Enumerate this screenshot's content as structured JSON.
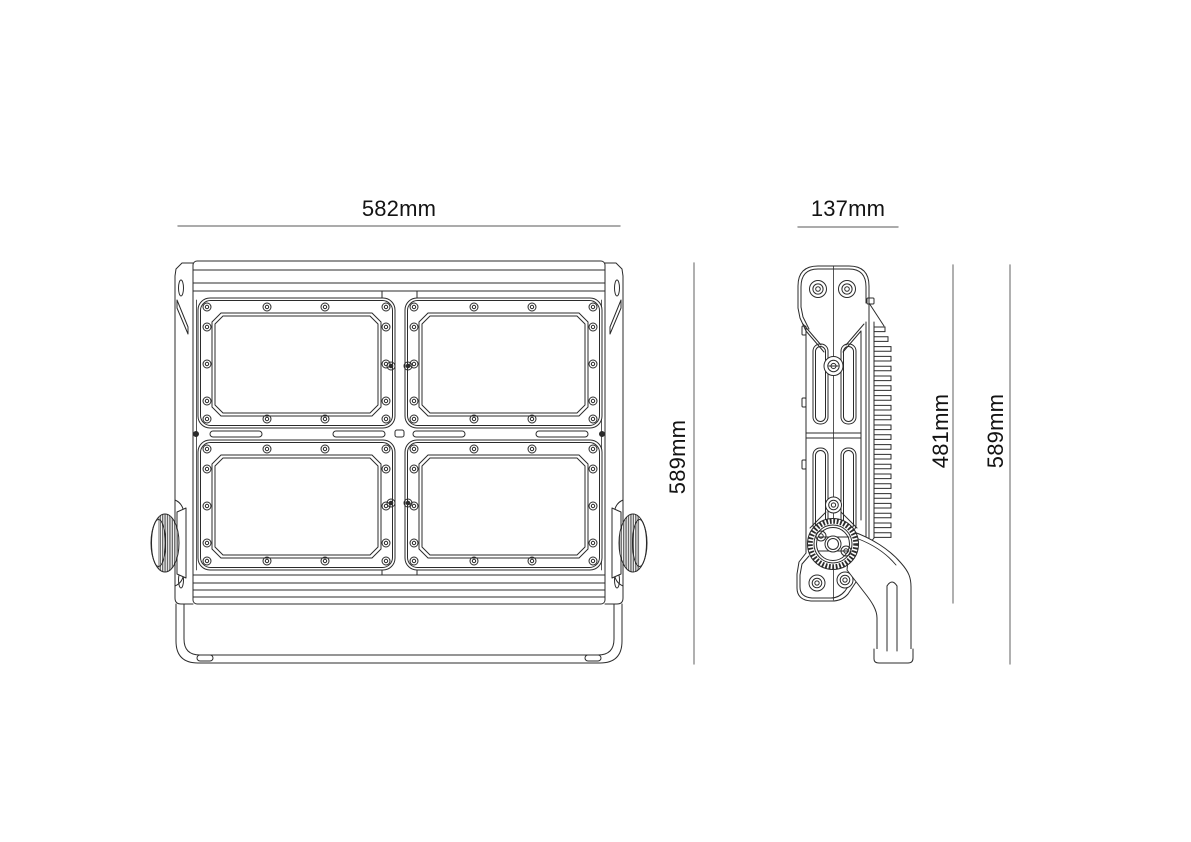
{
  "page": {
    "background": "#ffffff",
    "line_color": "#2b2b2b",
    "dim_line_color": "#8f8f8f",
    "text_color": "#131313"
  },
  "drawing": {
    "subject": "led-floodlight-technical-drawing",
    "front_view": {
      "width_label": "582mm",
      "height_label": "589mm"
    },
    "side_view": {
      "depth_label": "137mm",
      "body_height_label": "481mm",
      "overall_height_label": "589mm"
    }
  }
}
